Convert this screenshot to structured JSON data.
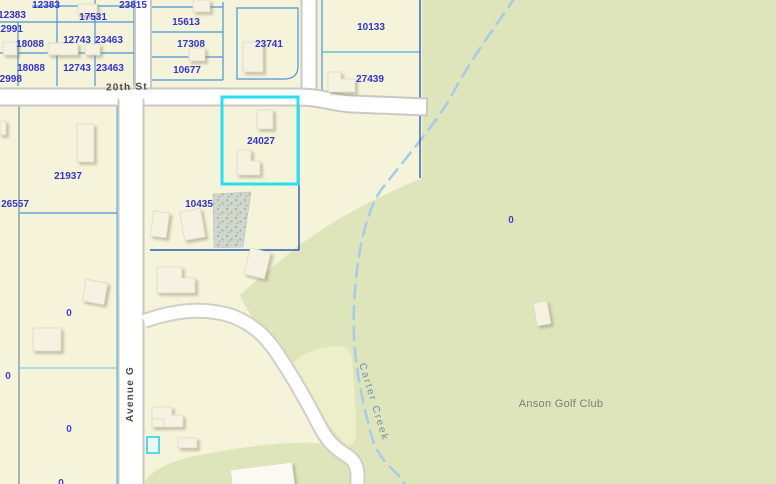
{
  "map": {
    "selected_parcel": "24027",
    "parcel_labels": [
      "12383",
      "23815",
      "12383",
      "17531",
      "12991",
      "18088",
      "12743",
      "23463",
      "18088",
      "12743",
      "23463",
      "12998",
      "15613",
      "17308",
      "10677",
      "23741",
      "10133",
      "27439",
      "24027",
      "10435",
      "21937",
      "26557"
    ],
    "zero_labels": [
      "0",
      "0",
      "0",
      "0",
      "0"
    ],
    "streets": {
      "twentieth": "20th St",
      "avenue_g": "Avenue G"
    },
    "creek_label": "Carter Creek",
    "golf_club_label": "Anson Golf Club",
    "colors": {
      "parcel_fill": "#f5f3d9",
      "golf_green": "#dee5bb",
      "golf_green_light": "#ecefca",
      "road_white": "#ffffff",
      "road_casing": "#c9c9c2",
      "parcel_line_blue": "#4596dc",
      "parcel_line_dark": "#2b5cb0",
      "parcel_line_cyan": "#7fd2ee",
      "selection_cyan": "#29dff2",
      "label_blue": "#3434cf",
      "street_label_gray": "#4b4b48",
      "creek_blue": "#a9cbe8",
      "creek_label_gray_blue": "#7090ac",
      "poi_label_gray": "#7d7d74",
      "building_fill": "#f6f2e2"
    }
  }
}
